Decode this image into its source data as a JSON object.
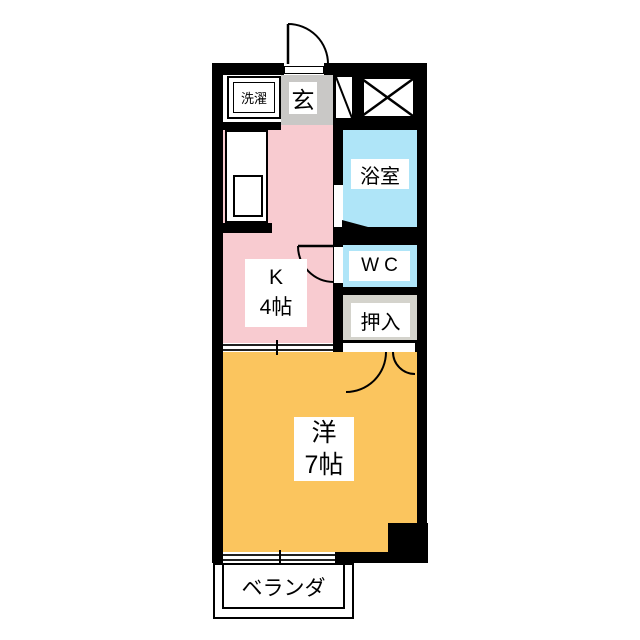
{
  "plan": {
    "type": "floor-plan",
    "rooms": {
      "laundry": {
        "label": "洗濯"
      },
      "entrance": {
        "label": "玄"
      },
      "bath": {
        "label": "浴室"
      },
      "toilet": {
        "label": "WC"
      },
      "closet": {
        "label": "押入"
      },
      "kitchen": {
        "label": "K",
        "size": "4帖"
      },
      "main_room": {
        "label": "洋",
        "size": "7帖"
      },
      "balcony": {
        "label": "ベランダ"
      }
    },
    "colors": {
      "wall": "#000000",
      "kitchen_floor": "#F8CBD0",
      "room_floor": "#FBC55E",
      "wet_area": "#AFE5F8",
      "entrance_floor": "#C9C8C6",
      "closet_floor": "#D4D3CC",
      "background": "#FFFFFF"
    }
  }
}
